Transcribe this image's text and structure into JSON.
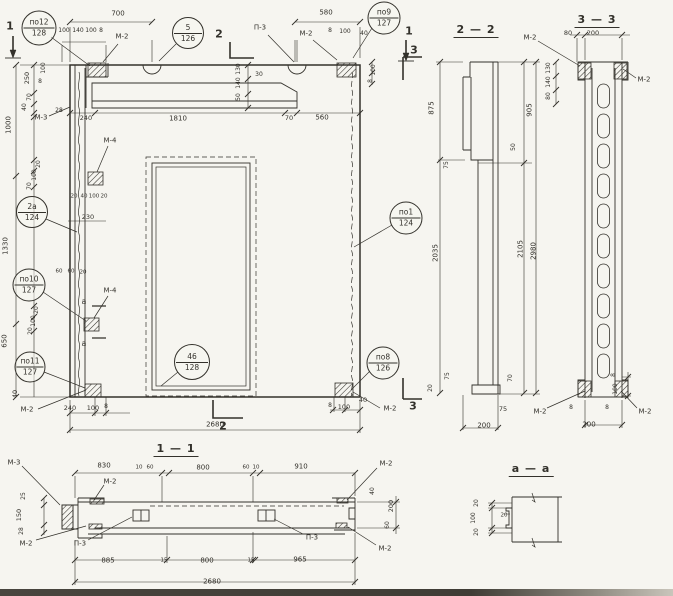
{
  "meta": {
    "ink": "#33312b",
    "paper": "#f6f5f0"
  },
  "section_titles": [
    {
      "t": "1 — 1",
      "x": 176,
      "y": 450
    },
    {
      "t": "2 — 2",
      "x": 476,
      "y": 31
    },
    {
      "t": "3 — 3",
      "x": 597,
      "y": 21
    },
    {
      "t": "а — а",
      "x": 531,
      "y": 470
    }
  ],
  "cut_markers": [
    {
      "t": "1",
      "x": 10,
      "y": 26
    },
    {
      "t": "1",
      "x": 409,
      "y": 31
    },
    {
      "t": "2",
      "x": 219,
      "y": 34
    },
    {
      "t": "2",
      "x": 223,
      "y": 426
    },
    {
      "t": "3",
      "x": 414,
      "y": 50
    },
    {
      "t": "3",
      "x": 413,
      "y": 406
    }
  ],
  "callouts": [
    {
      "top": "по12",
      "bottom": "128",
      "x": 39,
      "y": 28,
      "d": 33
    },
    {
      "top": "5",
      "bottom": "126",
      "x": 188,
      "y": 33,
      "d": 30
    },
    {
      "top": "по9",
      "bottom": "127",
      "x": 384,
      "y": 18,
      "d": 31
    },
    {
      "top": "2а",
      "bottom": "124",
      "x": 32,
      "y": 212,
      "d": 30
    },
    {
      "top": "по10",
      "bottom": "127",
      "x": 29,
      "y": 285,
      "d": 31
    },
    {
      "top": "по11",
      "bottom": "127",
      "x": 30,
      "y": 367,
      "d": 29
    },
    {
      "top": "46",
      "bottom": "128",
      "x": 192,
      "y": 362,
      "d": 34
    },
    {
      "top": "по1",
      "bottom": "124",
      "x": 406,
      "y": 218,
      "d": 31
    },
    {
      "top": "по8",
      "bottom": "126",
      "x": 383,
      "y": 363,
      "d": 31
    }
  ],
  "annotations": [
    {
      "t": "700",
      "x": 118,
      "y": 14
    },
    {
      "t": "100",
      "x": 64,
      "y": 31,
      "s": 6
    },
    {
      "t": "140",
      "x": 78,
      "y": 31,
      "s": 6
    },
    {
      "t": "100",
      "x": 91,
      "y": 31,
      "s": 6
    },
    {
      "t": "8",
      "x": 101,
      "y": 31,
      "s": 6
    },
    {
      "t": "М-2",
      "x": 122,
      "y": 37,
      "n": "part-label"
    },
    {
      "t": "П-3",
      "x": 260,
      "y": 28,
      "n": "part-label"
    },
    {
      "t": "М-2",
      "x": 306,
      "y": 34,
      "n": "part-label"
    },
    {
      "t": "580",
      "x": 326,
      "y": 13
    },
    {
      "t": "8",
      "x": 330,
      "y": 31,
      "s": 6
    },
    {
      "t": "100",
      "x": 345,
      "y": 32,
      "s": 6
    },
    {
      "t": "40",
      "x": 364,
      "y": 34,
      "s": 6
    },
    {
      "t": "100",
      "x": 374,
      "y": 70,
      "r": -90,
      "s": 6
    },
    {
      "t": "8",
      "x": 371,
      "y": 81,
      "r": -90,
      "s": 6
    },
    {
      "t": "130",
      "x": 239,
      "y": 69,
      "r": -90,
      "s": 6
    },
    {
      "t": "140",
      "x": 239,
      "y": 83,
      "r": -90,
      "s": 6
    },
    {
      "t": "50",
      "x": 239,
      "y": 97,
      "r": -90,
      "s": 6
    },
    {
      "t": "30",
      "x": 259,
      "y": 75,
      "s": 6
    },
    {
      "t": "250",
      "x": 27,
      "y": 78,
      "r": -90,
      "s": 6.5
    },
    {
      "t": "100",
      "x": 44,
      "y": 68,
      "r": -90,
      "s": 6
    },
    {
      "t": "8",
      "x": 40,
      "y": 82,
      "s": 6
    },
    {
      "t": "70",
      "x": 30,
      "y": 97,
      "r": -90,
      "s": 6
    },
    {
      "t": "40",
      "x": 25,
      "y": 107,
      "r": -90,
      "s": 6
    },
    {
      "t": "М-3",
      "x": 41,
      "y": 118,
      "n": "part-label"
    },
    {
      "t": "28",
      "x": 59,
      "y": 111,
      "s": 6
    },
    {
      "t": "1000",
      "x": 9,
      "y": 125,
      "r": -90
    },
    {
      "t": "240",
      "x": 86,
      "y": 118,
      "s": 6.5
    },
    {
      "t": "1810",
      "x": 178,
      "y": 119
    },
    {
      "t": "70",
      "x": 289,
      "y": 118,
      "s": 6.5
    },
    {
      "t": "560",
      "x": 322,
      "y": 118
    },
    {
      "t": "20",
      "x": 39,
      "y": 164,
      "r": -90,
      "s": 6
    },
    {
      "t": "100",
      "x": 35,
      "y": 175,
      "r": -90,
      "s": 6
    },
    {
      "t": "70",
      "x": 30,
      "y": 186,
      "r": -90,
      "s": 6
    },
    {
      "t": "1330",
      "x": 6,
      "y": 246,
      "r": -90
    },
    {
      "t": "М-4",
      "x": 110,
      "y": 141,
      "n": "part-label"
    },
    {
      "t": "20",
      "x": 74,
      "y": 197,
      "s": 5.5
    },
    {
      "t": "40",
      "x": 84,
      "y": 197,
      "s": 5.5
    },
    {
      "t": "100",
      "x": 94,
      "y": 197,
      "s": 5.5
    },
    {
      "t": "20",
      "x": 104,
      "y": 197,
      "s": 5.5
    },
    {
      "t": "230",
      "x": 88,
      "y": 217,
      "s": 6.5
    },
    {
      "t": "60",
      "x": 59,
      "y": 272,
      "s": 5.5
    },
    {
      "t": "60",
      "x": 71,
      "y": 272,
      "s": 5.5
    },
    {
      "t": "20",
      "x": 83,
      "y": 273,
      "s": 5.5
    },
    {
      "t": "20",
      "x": 37,
      "y": 310,
      "r": -90,
      "s": 6
    },
    {
      "t": "100",
      "x": 34,
      "y": 321,
      "r": -90,
      "s": 6
    },
    {
      "t": "20",
      "x": 31,
      "y": 331,
      "r": -90,
      "s": 6
    },
    {
      "t": "650",
      "x": 5,
      "y": 341,
      "r": -90
    },
    {
      "t": "М-4",
      "x": 110,
      "y": 291,
      "n": "part-label"
    },
    {
      "t": "а",
      "x": 84,
      "y": 302,
      "s": 8
    },
    {
      "t": "а",
      "x": 84,
      "y": 344,
      "s": 8
    },
    {
      "t": "40",
      "x": 15,
      "y": 394,
      "r": -90,
      "s": 6.5
    },
    {
      "t": "М-2",
      "x": 27,
      "y": 410,
      "n": "part-label"
    },
    {
      "t": "240",
      "x": 70,
      "y": 408,
      "s": 6.5
    },
    {
      "t": "100",
      "x": 93,
      "y": 408,
      "s": 6.5
    },
    {
      "t": "8",
      "x": 106,
      "y": 407,
      "s": 6
    },
    {
      "t": "2680",
      "x": 215,
      "y": 425
    },
    {
      "t": "8",
      "x": 330,
      "y": 406,
      "s": 6
    },
    {
      "t": "100",
      "x": 344,
      "y": 407,
      "s": 6.5
    },
    {
      "t": "40",
      "x": 363,
      "y": 400,
      "s": 6.5
    },
    {
      "t": "М-2",
      "x": 390,
      "y": 409,
      "n": "part-label"
    },
    {
      "t": "875",
      "x": 432,
      "y": 108,
      "r": -90
    },
    {
      "t": "905",
      "x": 530,
      "y": 110,
      "r": -90
    },
    {
      "t": "75",
      "x": 447,
      "y": 165,
      "r": -90,
      "s": 6
    },
    {
      "t": "50",
      "x": 514,
      "y": 147,
      "r": -90,
      "s": 6
    },
    {
      "t": "2035",
      "x": 436,
      "y": 253,
      "r": -90
    },
    {
      "t": "2105",
      "x": 521,
      "y": 249,
      "r": -90
    },
    {
      "t": "2980",
      "x": 534,
      "y": 251,
      "r": -90
    },
    {
      "t": "20",
      "x": 431,
      "y": 388,
      "r": -90,
      "s": 6
    },
    {
      "t": "75",
      "x": 448,
      "y": 376,
      "r": -90,
      "s": 6
    },
    {
      "t": "70",
      "x": 511,
      "y": 378,
      "r": -90,
      "s": 6
    },
    {
      "t": "75",
      "x": 503,
      "y": 409,
      "s": 6.5
    },
    {
      "t": "200",
      "x": 484,
      "y": 426
    },
    {
      "t": "М-2",
      "x": 530,
      "y": 38,
      "n": "part-label"
    },
    {
      "t": "80",
      "x": 568,
      "y": 33,
      "s": 6.5
    },
    {
      "t": "200",
      "x": 593,
      "y": 33,
      "s": 6.5
    },
    {
      "t": "М-2",
      "x": 644,
      "y": 80,
      "n": "part-label"
    },
    {
      "t": "130",
      "x": 549,
      "y": 68,
      "r": -90,
      "s": 6
    },
    {
      "t": "140",
      "x": 549,
      "y": 82,
      "r": -90,
      "s": 6
    },
    {
      "t": "80",
      "x": 549,
      "y": 96,
      "r": -90,
      "s": 6
    },
    {
      "t": "8",
      "x": 614,
      "y": 375,
      "r": -90,
      "s": 6
    },
    {
      "t": "100",
      "x": 616,
      "y": 389,
      "r": -90,
      "s": 6
    },
    {
      "t": "М-2",
      "x": 540,
      "y": 412,
      "n": "part-label"
    },
    {
      "t": "8",
      "x": 571,
      "y": 408,
      "s": 6
    },
    {
      "t": "8",
      "x": 607,
      "y": 408,
      "s": 6
    },
    {
      "t": "М-2",
      "x": 645,
      "y": 412,
      "n": "part-label"
    },
    {
      "t": "200",
      "x": 589,
      "y": 425
    },
    {
      "t": "М-3",
      "x": 14,
      "y": 463,
      "n": "part-label"
    },
    {
      "t": "830",
      "x": 104,
      "y": 466
    },
    {
      "t": "10",
      "x": 139,
      "y": 468,
      "s": 5.5
    },
    {
      "t": "60",
      "x": 150,
      "y": 468,
      "s": 5.5
    },
    {
      "t": "800",
      "x": 203,
      "y": 468
    },
    {
      "t": "60",
      "x": 246,
      "y": 468,
      "s": 5.5
    },
    {
      "t": "10",
      "x": 256,
      "y": 468,
      "s": 5.5
    },
    {
      "t": "910",
      "x": 301,
      "y": 467
    },
    {
      "t": "М-2",
      "x": 110,
      "y": 482,
      "n": "part-label"
    },
    {
      "t": "М-2",
      "x": 386,
      "y": 464,
      "n": "part-label"
    },
    {
      "t": "25",
      "x": 24,
      "y": 496,
      "r": -90,
      "s": 6
    },
    {
      "t": "150",
      "x": 19,
      "y": 515,
      "r": -90,
      "s": 6.5
    },
    {
      "t": "28",
      "x": 22,
      "y": 531,
      "r": -90,
      "s": 6
    },
    {
      "t": "М-2",
      "x": 26,
      "y": 544,
      "n": "part-label"
    },
    {
      "t": "П-3",
      "x": 80,
      "y": 544,
      "n": "part-label"
    },
    {
      "t": "П-3",
      "x": 312,
      "y": 538,
      "n": "part-label"
    },
    {
      "t": "40",
      "x": 373,
      "y": 491,
      "r": -90,
      "s": 6
    },
    {
      "t": "200",
      "x": 391,
      "y": 506,
      "r": -90,
      "s": 6.5
    },
    {
      "t": "60",
      "x": 388,
      "y": 525,
      "r": -90,
      "s": 6
    },
    {
      "t": "М-2",
      "x": 385,
      "y": 549,
      "n": "part-label"
    },
    {
      "t": "885",
      "x": 108,
      "y": 561
    },
    {
      "t": "15",
      "x": 164,
      "y": 561,
      "s": 5.5
    },
    {
      "t": "800",
      "x": 207,
      "y": 561
    },
    {
      "t": "15",
      "x": 251,
      "y": 561,
      "s": 5.5
    },
    {
      "t": "965",
      "x": 300,
      "y": 560
    },
    {
      "t": "2680",
      "x": 212,
      "y": 582
    },
    {
      "t": "20",
      "x": 477,
      "y": 503,
      "r": -90,
      "s": 6
    },
    {
      "t": "100",
      "x": 474,
      "y": 518,
      "r": -90,
      "s": 6
    },
    {
      "t": "20",
      "x": 477,
      "y": 532,
      "r": -90,
      "s": 6
    },
    {
      "t": "20",
      "x": 504,
      "y": 516,
      "s": 5.5
    }
  ]
}
